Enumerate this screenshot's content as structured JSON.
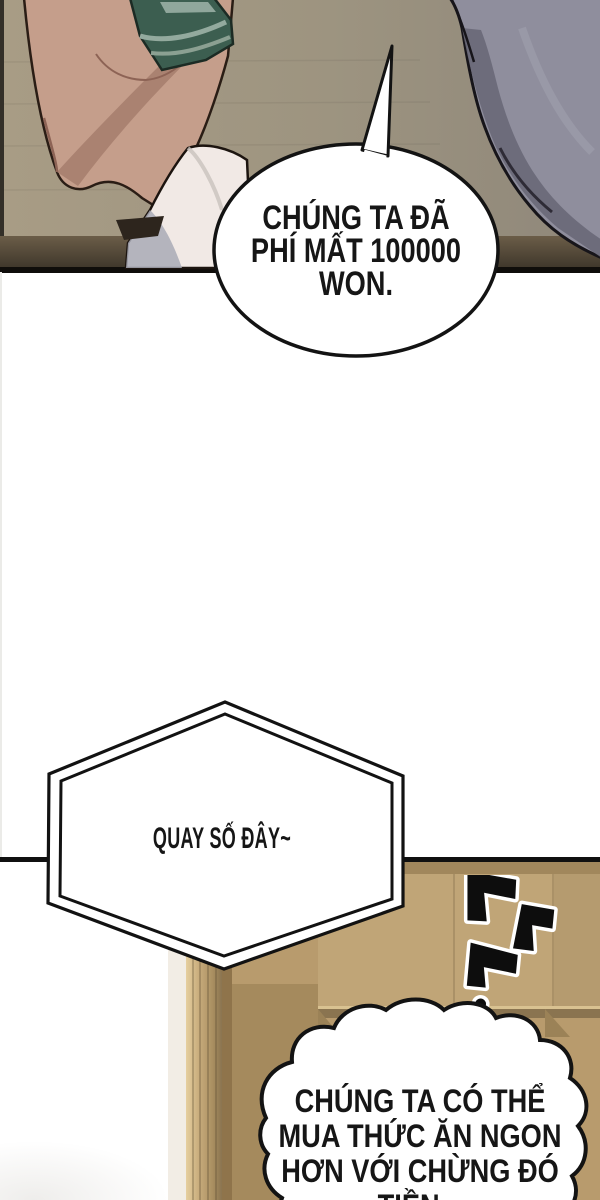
{
  "comic": {
    "bubble_top": {
      "lines": [
        "CHÚNG TA ĐÃ",
        "PHÍ MẤT 100000",
        "WON."
      ]
    },
    "bubble_hex": {
      "line": "QUAY SỐ ĐÂY~"
    },
    "bubble_cloud": {
      "lines": [
        "CHÚNG TA CÓ THỂ",
        "MUA THỨC ĂN NGON",
        "HƠN VỚI CHỪNG ĐÓ",
        "TIỀN..."
      ]
    },
    "sfx": {
      "meaning": "korean-brush-rattle-sfx"
    },
    "colors": {
      "ink": "#131313",
      "wall_top_panel": "#a89c85",
      "floor_band": "#5f5342",
      "skin": "#c59e8b",
      "skin_shadow": "#a57c6c",
      "sleeve": "#f1e9e5",
      "clothing_gray": "#8f8e9d",
      "money_green": "#3c5e50",
      "door_tan": "#b89b6d",
      "door_frame_light": "#d9c191"
    }
  }
}
